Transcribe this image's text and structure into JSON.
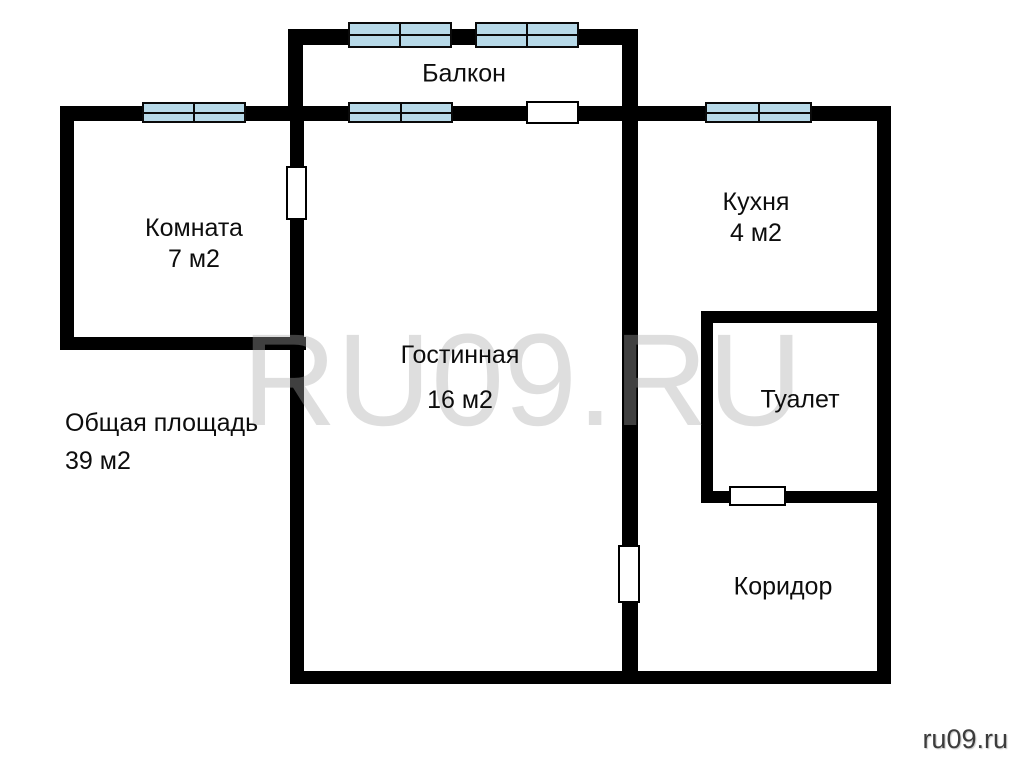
{
  "page": {
    "background": "#ffffff",
    "wall_color": "#000000",
    "window_color": "#b7d9e8",
    "text_color": "#0d0d0d"
  },
  "plan": {
    "walls": [
      {
        "name": "wall-balcony-top",
        "x": 288,
        "y": 29,
        "w": 349,
        "h": 16
      },
      {
        "name": "wall-balcony-left",
        "x": 288,
        "y": 29,
        "w": 15,
        "h": 77
      },
      {
        "name": "wall-outer-top",
        "x": 60,
        "y": 106,
        "w": 831,
        "h": 15
      },
      {
        "name": "wall-outer-left",
        "x": 60,
        "y": 106,
        "w": 14,
        "h": 244
      },
      {
        "name": "wall-room-bottom",
        "x": 60,
        "y": 337,
        "w": 246,
        "h": 13
      },
      {
        "name": "wall-living-left",
        "x": 290,
        "y": 106,
        "w": 14,
        "h": 578
      },
      {
        "name": "wall-center-divider",
        "x": 622,
        "y": 29,
        "w": 16,
        "h": 655
      },
      {
        "name": "wall-outer-right",
        "x": 877,
        "y": 106,
        "w": 14,
        "h": 578
      },
      {
        "name": "wall-outer-bottom",
        "x": 290,
        "y": 671,
        "w": 601,
        "h": 13
      },
      {
        "name": "wall-toilet-top",
        "x": 701,
        "y": 311,
        "w": 176,
        "h": 12
      },
      {
        "name": "wall-toilet-left",
        "x": 701,
        "y": 311,
        "w": 12,
        "h": 192
      },
      {
        "name": "wall-toilet-bottom",
        "x": 701,
        "y": 491,
        "w": 176,
        "h": 12
      }
    ],
    "windows": [
      {
        "name": "balcony-window-left",
        "x": 348,
        "y": 22,
        "w": 104,
        "h": 26
      },
      {
        "name": "balcony-window-right",
        "x": 475,
        "y": 22,
        "w": 104,
        "h": 26
      },
      {
        "name": "room-window",
        "x": 142,
        "y": 102,
        "w": 104,
        "h": 21
      },
      {
        "name": "living-window",
        "x": 348,
        "y": 102,
        "w": 105,
        "h": 21
      },
      {
        "name": "kitchen-window",
        "x": 705,
        "y": 102,
        "w": 107,
        "h": 21
      }
    ],
    "doors": [
      {
        "name": "balcony-door",
        "x": 526,
        "y": 101,
        "w": 53,
        "h": 23
      },
      {
        "name": "room-door",
        "x": 286,
        "y": 166,
        "w": 21,
        "h": 54
      },
      {
        "name": "living-door",
        "x": 618,
        "y": 545,
        "w": 22,
        "h": 58
      },
      {
        "name": "toilet-door",
        "x": 729,
        "y": 486,
        "w": 57,
        "h": 20
      }
    ],
    "labels": [
      {
        "id": "balcony",
        "lines": [
          "Балкон"
        ],
        "cx": 464,
        "cy": 74,
        "lh": 31
      },
      {
        "id": "room",
        "lines": [
          "Комната",
          "7 м2"
        ],
        "cx": 194,
        "cy": 244,
        "lh": 31
      },
      {
        "id": "living",
        "lines": [
          "Гостинная",
          "16 м2"
        ],
        "cx": 460,
        "cy": 378,
        "lh": 45
      },
      {
        "id": "kitchen",
        "lines": [
          "Кухня",
          "4 м2"
        ],
        "cx": 756,
        "cy": 218,
        "lh": 31
      },
      {
        "id": "toilet",
        "lines": [
          "Туалет"
        ],
        "cx": 800,
        "cy": 400,
        "lh": 31
      },
      {
        "id": "corridor",
        "lines": [
          "Коридор"
        ],
        "cx": 783,
        "cy": 587,
        "lh": 31
      }
    ]
  },
  "annotations": {
    "total_area_line1": "Общая площадь",
    "total_area_line2": "39 м2"
  },
  "watermark": {
    "text": "RU09.RU"
  },
  "site_credit": {
    "text": "ru09.ru"
  }
}
